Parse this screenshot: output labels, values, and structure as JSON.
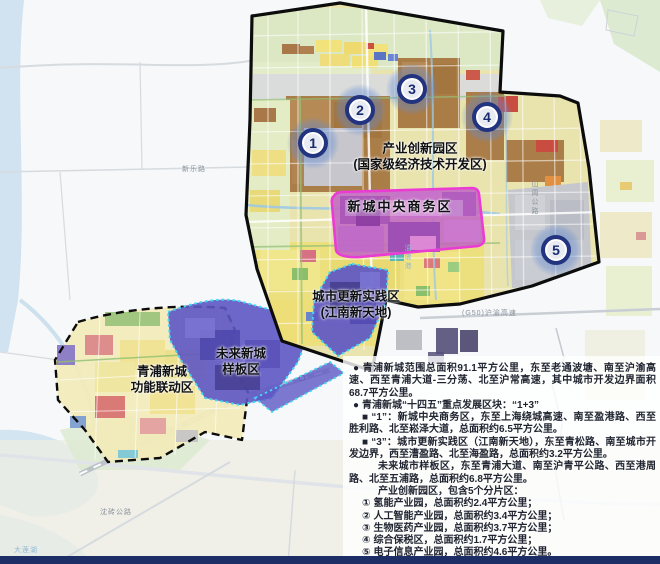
{
  "colors": {
    "boundary-black": "#0c0c0c",
    "cbd-border-magenta": "#ea3cd4",
    "zone-purple": "#5e57c4",
    "zone-dotted-cyan": "#3fd8f2",
    "marker-ring-navy": "#22337f",
    "marker-number-navy": "#1a2a6e",
    "water-blue": "#cadeef",
    "bottom-bar-navy": "#1d2e66",
    "panel-text": "#1f2430"
  },
  "map": {
    "zone_labels": {
      "industry_park": {
        "lines": [
          "产业创新园区",
          "(国家级经济技术开发区)"
        ]
      },
      "cbd": {
        "lines": [
          "新城中央商务区"
        ]
      },
      "urban_renewal": {
        "lines": [
          "城市更新实践区",
          "(江南新天地)"
        ]
      },
      "future_city": {
        "lines": [
          "未来新城",
          "样板区"
        ]
      },
      "linkage": {
        "lines": [
          "青浦新城",
          "功能联动区"
        ]
      }
    },
    "markers": [
      {
        "number": "1"
      },
      {
        "number": "2"
      },
      {
        "number": "3"
      },
      {
        "number": "4"
      },
      {
        "number": "5"
      }
    ],
    "road_labels": [
      {
        "text": "新乐路"
      },
      {
        "text": "山周公路"
      },
      {
        "text": "油墩港"
      },
      {
        "text": "(G50)沪渝高速"
      },
      {
        "text": "沈砖公路"
      },
      {
        "text": "大莲湖"
      }
    ]
  },
  "panel": {
    "paragraphs": [
      {
        "marker": "●",
        "text": "青浦新城范围总面积91.1平方公里，东至老通波塘、南至沪渝高速、西至青浦大道-三分荡、北至沪常高速，其中城市开发边界面积68.7平方公里。"
      },
      {
        "marker": "●",
        "text": "青浦新城“十四五”重点发展区块：“1+3”"
      },
      {
        "marker": "■",
        "text": "“1”：新城中央商务区，东至上海绕城高速、南至盈港路、西至胜利路、北至崧泽大道，总面积约6.5平方公里。"
      },
      {
        "marker": "■",
        "text": "“3”：城市更新实践区（江南新天地），东至青松路、南至城市开发边界，西至漕盈路、北至海盈路，总面积约3.2平方公里。"
      },
      {
        "marker": "",
        "text": "未来城市样板区，东至青浦大道、南至沪青平公路、西至港周路、北至五浦路，总面积约6.8平方公里。"
      },
      {
        "marker": "",
        "text": "产业创新园区，包含5个分片区："
      },
      {
        "marker": "①",
        "text": "氢能产业园，总面积约2.4平方公里；"
      },
      {
        "marker": "②",
        "text": "人工智能产业园，总面积约3.4平方公里；"
      },
      {
        "marker": "③",
        "text": "生物医药产业园，总面积约3.7平方公里；"
      },
      {
        "marker": "④",
        "text": "综合保税区，总面积约1.7平方公里；"
      },
      {
        "marker": "⑤",
        "text": "电子信息产业园，总面积约4.6平方公里。"
      }
    ]
  }
}
